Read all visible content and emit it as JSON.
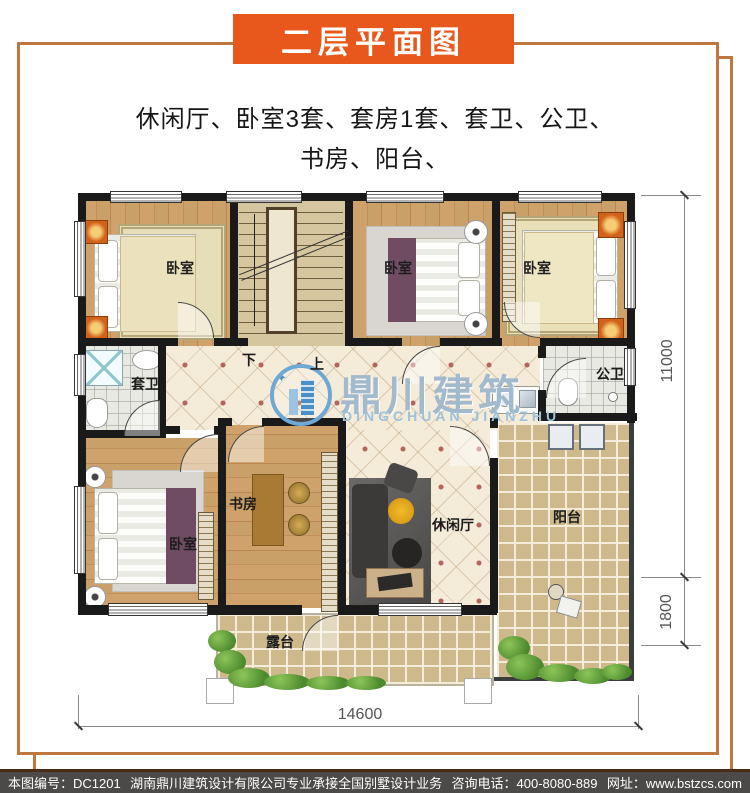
{
  "page": {
    "banner_title": "二层平面图",
    "subtitle_line1": "休闲厅、卧室3套、套房1套、套卫、公卫、",
    "subtitle_line2": "书房、阳台、",
    "accent_color": "#e8581c",
    "frame_color": "#c0773f"
  },
  "watermark": {
    "name_cn": "鼎川建筑",
    "name_en": "DINGCHUAN JIANZHU"
  },
  "plan": {
    "room_labels": {
      "bedroom_top_left": "卧室",
      "bedroom_top_middle": "卧室",
      "bedroom_top_right": "卧室",
      "bedroom_bottom_left": "卧室",
      "ensuite_bath": "套卫",
      "public_bath": "公卫",
      "study": "书房",
      "leisure_hall": "休闲厅",
      "balcony": "阳台",
      "terrace": "露台",
      "stair_down": "下",
      "stair_up": "上"
    },
    "dimensions": {
      "bottom_width": "14600",
      "right_height_main": "11000",
      "right_height_lower": "1800"
    }
  },
  "footer": {
    "drawing_no": "本图编号：DC1201",
    "company": "湖南鼎川建筑设计有限公司专业承接全国别墅设计业务",
    "phone": "咨询电话：400-8080-889",
    "website": "网址：www.bstzcs.com"
  }
}
